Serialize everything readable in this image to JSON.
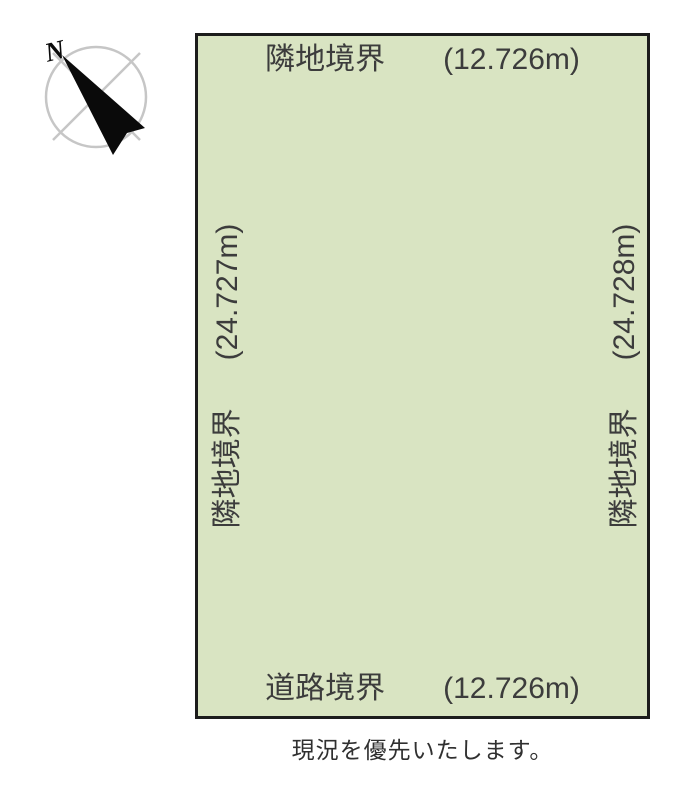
{
  "compass": {
    "north_label": "N"
  },
  "plot": {
    "fill_color": "#d9e4c2",
    "border_color": "#1c1c1c",
    "boundaries": {
      "top": {
        "name": "隣地境界",
        "length": "(12.726m)"
      },
      "left": {
        "name": "隣地境界",
        "length": "(24.727m)"
      },
      "right": {
        "name": "隣地境界",
        "length": "(24.728m)"
      },
      "bottom": {
        "name": "道路境界",
        "length": "(12.726m)"
      }
    }
  },
  "footnote": "現況を優先いたします。"
}
